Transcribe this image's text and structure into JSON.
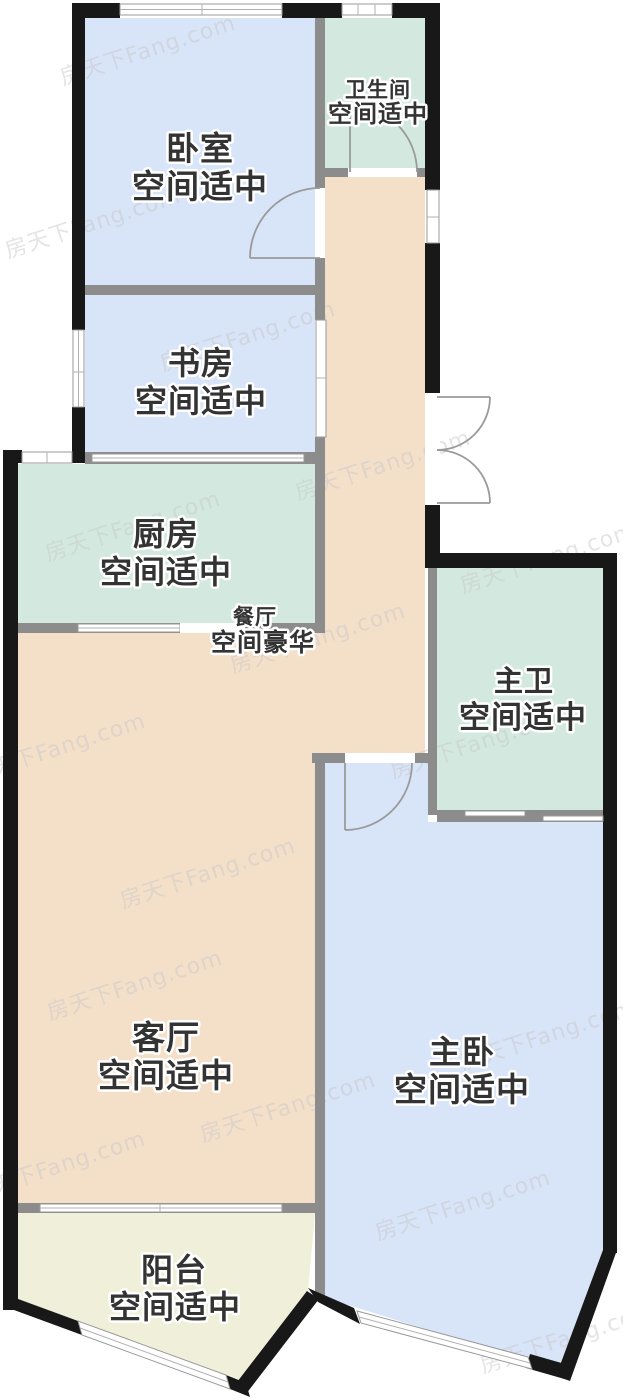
{
  "watermark_text": "房天下Fang.com",
  "colors": {
    "room_blue": "#d8e4f8",
    "room_green": "#d3e9e0",
    "room_beige": "#f4e0c9",
    "room_cream": "#f0efda",
    "wall_dark": "#181818",
    "wall_gray": "#8c8c8c",
    "label_text": "#333333",
    "watermark_gray": "#c9c9c9"
  },
  "rooms": {
    "bedroom": {
      "name": "卧室",
      "grade": "空间适中"
    },
    "bathroom": {
      "name": "卫生间",
      "grade": "空间适中"
    },
    "study": {
      "name": "书房",
      "grade": "空间适中"
    },
    "kitchen": {
      "name": "厨房",
      "grade": "空间适中"
    },
    "dining": {
      "name": "餐厅",
      "grade": "空间豪华"
    },
    "master_bathroom": {
      "name": "主卫",
      "grade": "空间适中"
    },
    "living_room": {
      "name": "客厅",
      "grade": "空间适中"
    },
    "master_bedroom": {
      "name": "主卧",
      "grade": "空间适中"
    },
    "balcony": {
      "name": "阳台",
      "grade": "空间适中"
    }
  }
}
